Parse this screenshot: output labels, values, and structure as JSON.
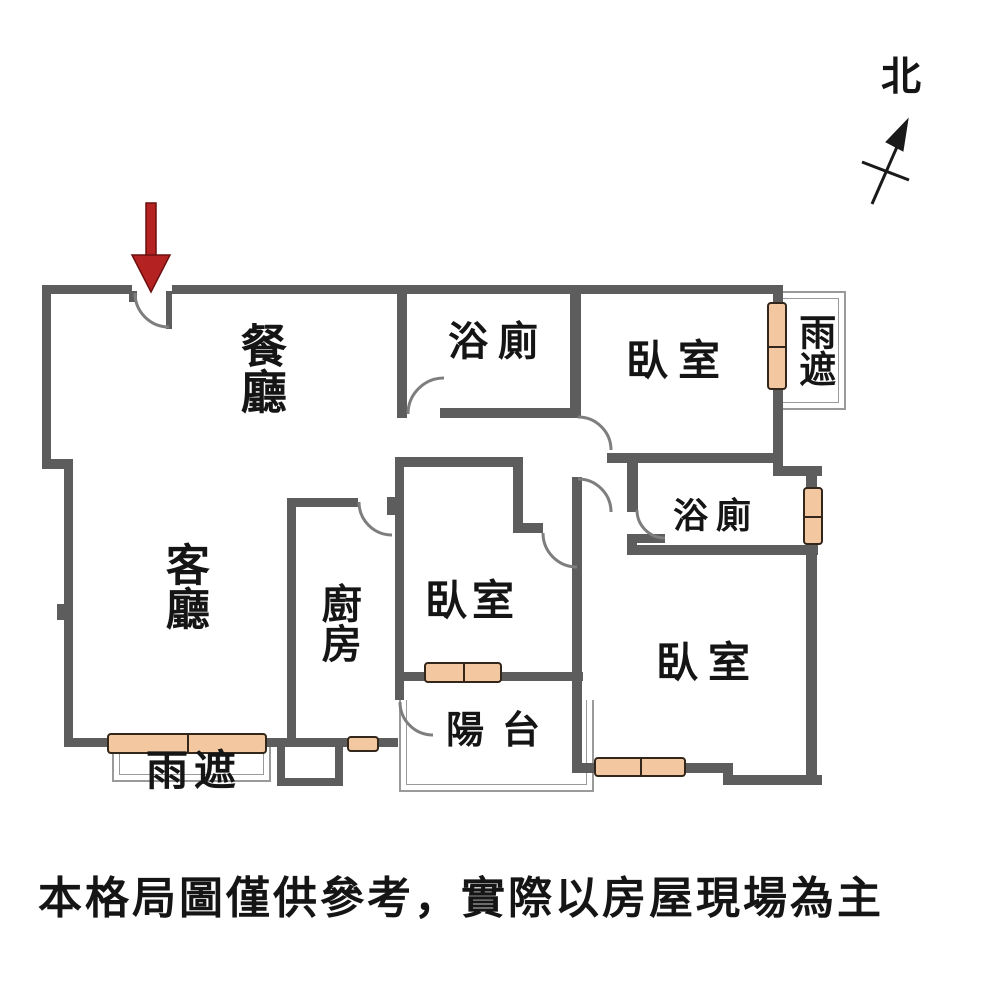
{
  "figure": {
    "type": "floor-plan",
    "disclaimer": "本格局圖僅供參考，實際以房屋現場為主",
    "compass": {
      "north_label": "北"
    }
  },
  "rooms": {
    "dining": {
      "label": "餐廳"
    },
    "living": {
      "label": "客廳"
    },
    "kitchen": {
      "label": "廚房"
    },
    "bath1": {
      "label": "浴廁"
    },
    "bath2": {
      "label": "浴廁"
    },
    "bedroom1": {
      "label": "臥室"
    },
    "bedroom2": {
      "label": "臥室"
    },
    "bedroom3": {
      "label": "臥室"
    },
    "balcony": {
      "label": "陽台"
    },
    "canopy_right": {
      "label": "雨遮"
    },
    "canopy_bottom": {
      "label": "雨遮"
    }
  },
  "colors": {
    "wall": "#5d5d5d",
    "window_fill": "#f3c7a0",
    "window_border": "#33261a",
    "thin_line": "#9a9a9a",
    "arc_line": "#7e7e7e",
    "entry_arrow": "#b42222",
    "entry_arrow_edge": "#6d0f0f",
    "ink": "#151515"
  }
}
